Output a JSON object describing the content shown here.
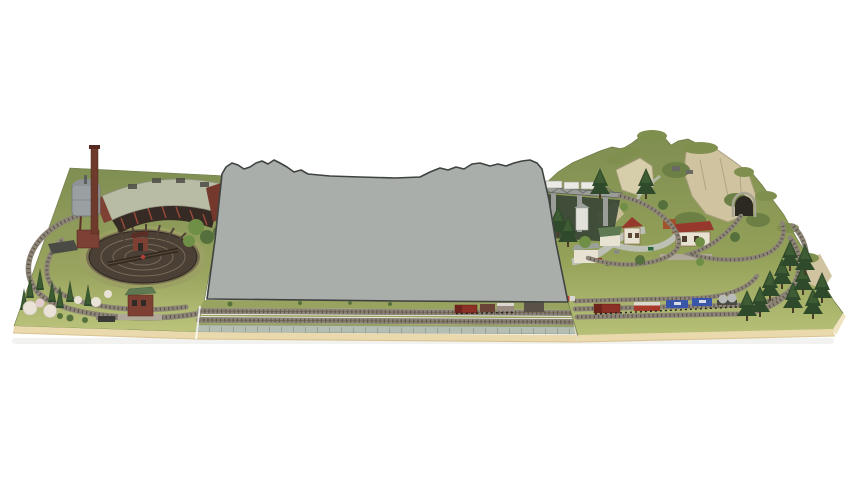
{
  "meta": {
    "title": "Model railway layout photo with gray-masked center module",
    "description": "Product photograph of an N-scale model railway layout. Left module: engine depot with turntable, roundhouse, water tower and chimney inside an oval of track. Center module: hidden behind a flat gray silhouette placeholder with a jagged mountain-like top edge; only the front yard tracks and retaining wall are visible. Right module: rocky mountain with tunnel portal, viaduct over a gorge, small village with houses and station, curving tracks and a freight train, pine trees along the edge."
  },
  "scene": {
    "background": "#ffffff",
    "modules": [
      {
        "id": "left",
        "name": "engine-depot-module",
        "features": [
          "oval track loop",
          "turntable pit",
          "roundhouse",
          "water tower",
          "brick chimney",
          "signal box",
          "conifers",
          "blossoming bushes",
          "coal bunker"
        ]
      },
      {
        "id": "center",
        "name": "masked-center-module",
        "features": [
          "gray placeholder silhouette",
          "two front yard tracks",
          "stone retaining wall",
          "small shuttle train",
          "lineside shed"
        ]
      },
      {
        "id": "right",
        "name": "mountain-village-module",
        "features": [
          "rocky mountain",
          "tunnel portal",
          "viaduct with white train",
          "village houses",
          "station building",
          "roads with cars",
          "freight train",
          "pine tree cluster"
        ]
      }
    ]
  },
  "palette": {
    "background": "#ffffff",
    "board_edge": "#ead9ad",
    "board_edge_light": "#f0e4c0",
    "board_edge_shadow": "#d8c493",
    "grass_mid": "#98a35f",
    "ballast": "#8d8678",
    "ties": "#5d5548",
    "rail": "#6b6152",
    "mask_fill": "#a9aeab",
    "mask_outline": "#3f4340",
    "wall": "#b5beb2",
    "wall_joint": "#8f988c",
    "pit": "#4a4036",
    "pit_ring": "#7a6a58",
    "apron": "#9aa162",
    "dirt_ring": "#7b6f52",
    "roundhouse_roof": "#b8bca4",
    "roundhouse_wall": "#7d4032",
    "roundhouse_dark": "#352a24",
    "brick_dark": "#74382c",
    "column_red": "#9c4a3a",
    "chimney": "#6e3a2c",
    "tank": "#9aa0a2",
    "tank_dome": "#8d9396",
    "tower_base": "#7c4034",
    "conifer": "#2f4a2a",
    "conifer_light": "#47663a",
    "leaf": "#6f8f46",
    "leaf_dark": "#55703c",
    "blossom": "#e9e2d6",
    "blossom_pink": "#e2ccce",
    "rock": "#cfc49f",
    "rock_light": "#d6cdaa",
    "rock_mid": "#c9bd98",
    "rock_shade": "#a89d7e",
    "mountain_green": "#7e8f4e",
    "slope_green": "#6c8045",
    "tunnel": "#2c2822",
    "portal": "#a9a593",
    "road": "#bcc0b5",
    "roof_red": "#96392c",
    "roof_green": "#5f7a52",
    "house_wall": "#e8e2d2",
    "silo_white": "#e3e2da",
    "container_rust": "#a0522d",
    "bridge": "#9b9d99",
    "bridge_dark": "#5c5e5a",
    "gorge": "#3a4636",
    "loco_red": "#8c2f24",
    "loco_cab": "#6d241c",
    "wagon_red": "#a83a2c",
    "wagon_white_top": "#dcd8d0",
    "wagon_blue": "#3a56a8",
    "wagon_maroon": "#6b4438",
    "wagon_gray": "#9a8c80",
    "silo": "#b7bab6",
    "train_white": "#eceae4",
    "platform": "#b0a898",
    "shed_roof": "#c2a97c",
    "shed_wall": "#5a5248",
    "dark_metal": "#3a3a36",
    "cabin_gray": "#6a6a64",
    "shadow": "#e7e7e3"
  }
}
